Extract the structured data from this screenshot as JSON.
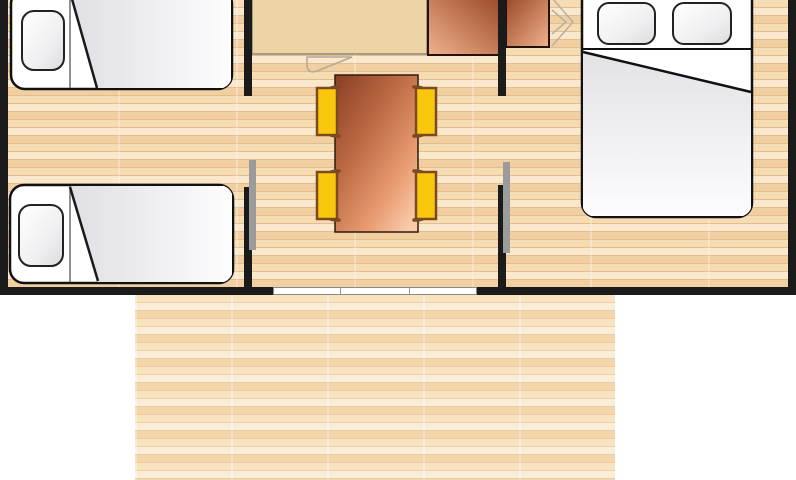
{
  "floorplan": {
    "description": "Top-down floor plan of a mobile home (top edge cropped) with a wooden terrace extending below the entrance",
    "colors": {
      "wall": "#1b1b1b",
      "door_leaf": "#9b9b9b",
      "sliding_door": "#ffffff",
      "floor_plank_light": "#f9e8cb",
      "floor_plank_mid": "#f6dcb3",
      "floor_plank_dark": "#f2cfa1",
      "terrace_plank_light": "#fbeed8",
      "terrace_plank_mid": "#f8e2c0",
      "terrace_plank_dark": "#f4d6ab",
      "counter": "#ecd4a6",
      "copper_dark": "#9a4826",
      "copper_light": "#f0b28d",
      "table_dark": "#8a3e24",
      "table_light": "#f8caa9",
      "chair_seat": "#f9c70c",
      "chair_frame": "#7b4a20",
      "bed_fill": "#ffffff",
      "bed_outline": "#111111",
      "blanket_shade": "#e3e3e7"
    },
    "rooms": {
      "left_bedroom": {
        "furniture": [
          "single-bed",
          "single-bed"
        ]
      },
      "living_kitchen": {
        "furniture": [
          "kitchen-counter",
          "kitchen-unit",
          "dining-table",
          "chair",
          "chair",
          "chair",
          "chair"
        ]
      },
      "right_bedroom": {
        "furniture": [
          "wardrobe-unit",
          "folding-door",
          "double-bed"
        ]
      }
    },
    "openings": [
      "left-bedroom-door",
      "right-bedroom-door",
      "sliding-patio-door"
    ],
    "outdoor": {
      "terrace": true
    }
  }
}
